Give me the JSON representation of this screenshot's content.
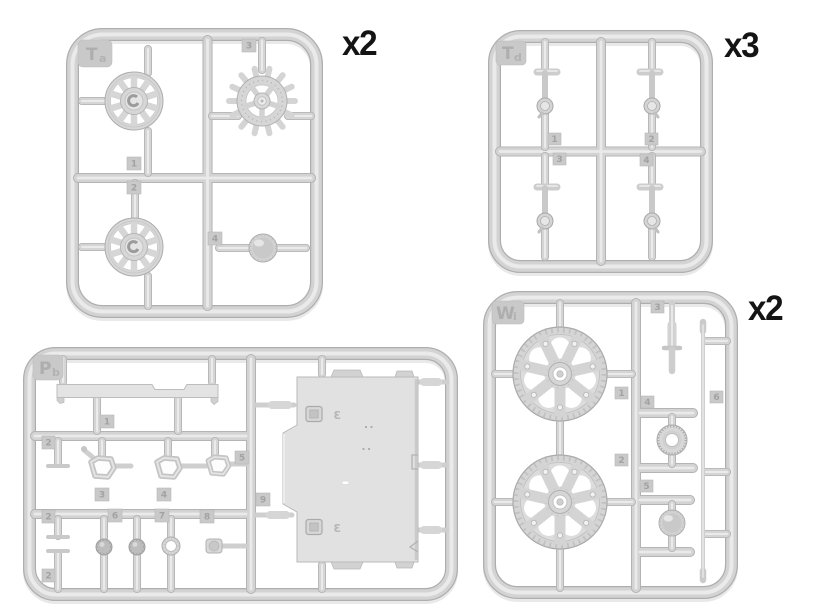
{
  "palette": {
    "background": "#ffffff",
    "plastic_base": "#d3d3d3",
    "plastic_highlight": "#eaeaea",
    "plastic_shadow": "#aeaeae",
    "embossed_text": "#a2a2a2",
    "quantity_label_color": "#141414"
  },
  "sprues": {
    "ta": {
      "tag_main": "T",
      "tag_sub": "a",
      "quantity": "x2",
      "parts": {
        "p1": "1",
        "p2": "2",
        "p3": "3",
        "p4": "4"
      }
    },
    "td": {
      "tag_main": "T",
      "tag_sub": "d",
      "quantity": "x3",
      "parts": {
        "p1": "1",
        "p2": "2",
        "p3": "3",
        "p4": "4"
      }
    },
    "wi": {
      "tag_main": "W",
      "tag_sub": "i",
      "quantity": "x2",
      "parts": {
        "p1": "1",
        "p2": "2",
        "p3": "3",
        "p4": "4",
        "p5": "5",
        "p6": "6"
      }
    },
    "pb": {
      "tag_main": "P",
      "tag_sub": "b",
      "parts": {
        "p1": "1",
        "p2": "2",
        "p3": "3",
        "p4": "4",
        "p5": "5",
        "p6": "6",
        "p7": "7",
        "p8": "8",
        "p9": "9"
      }
    }
  }
}
